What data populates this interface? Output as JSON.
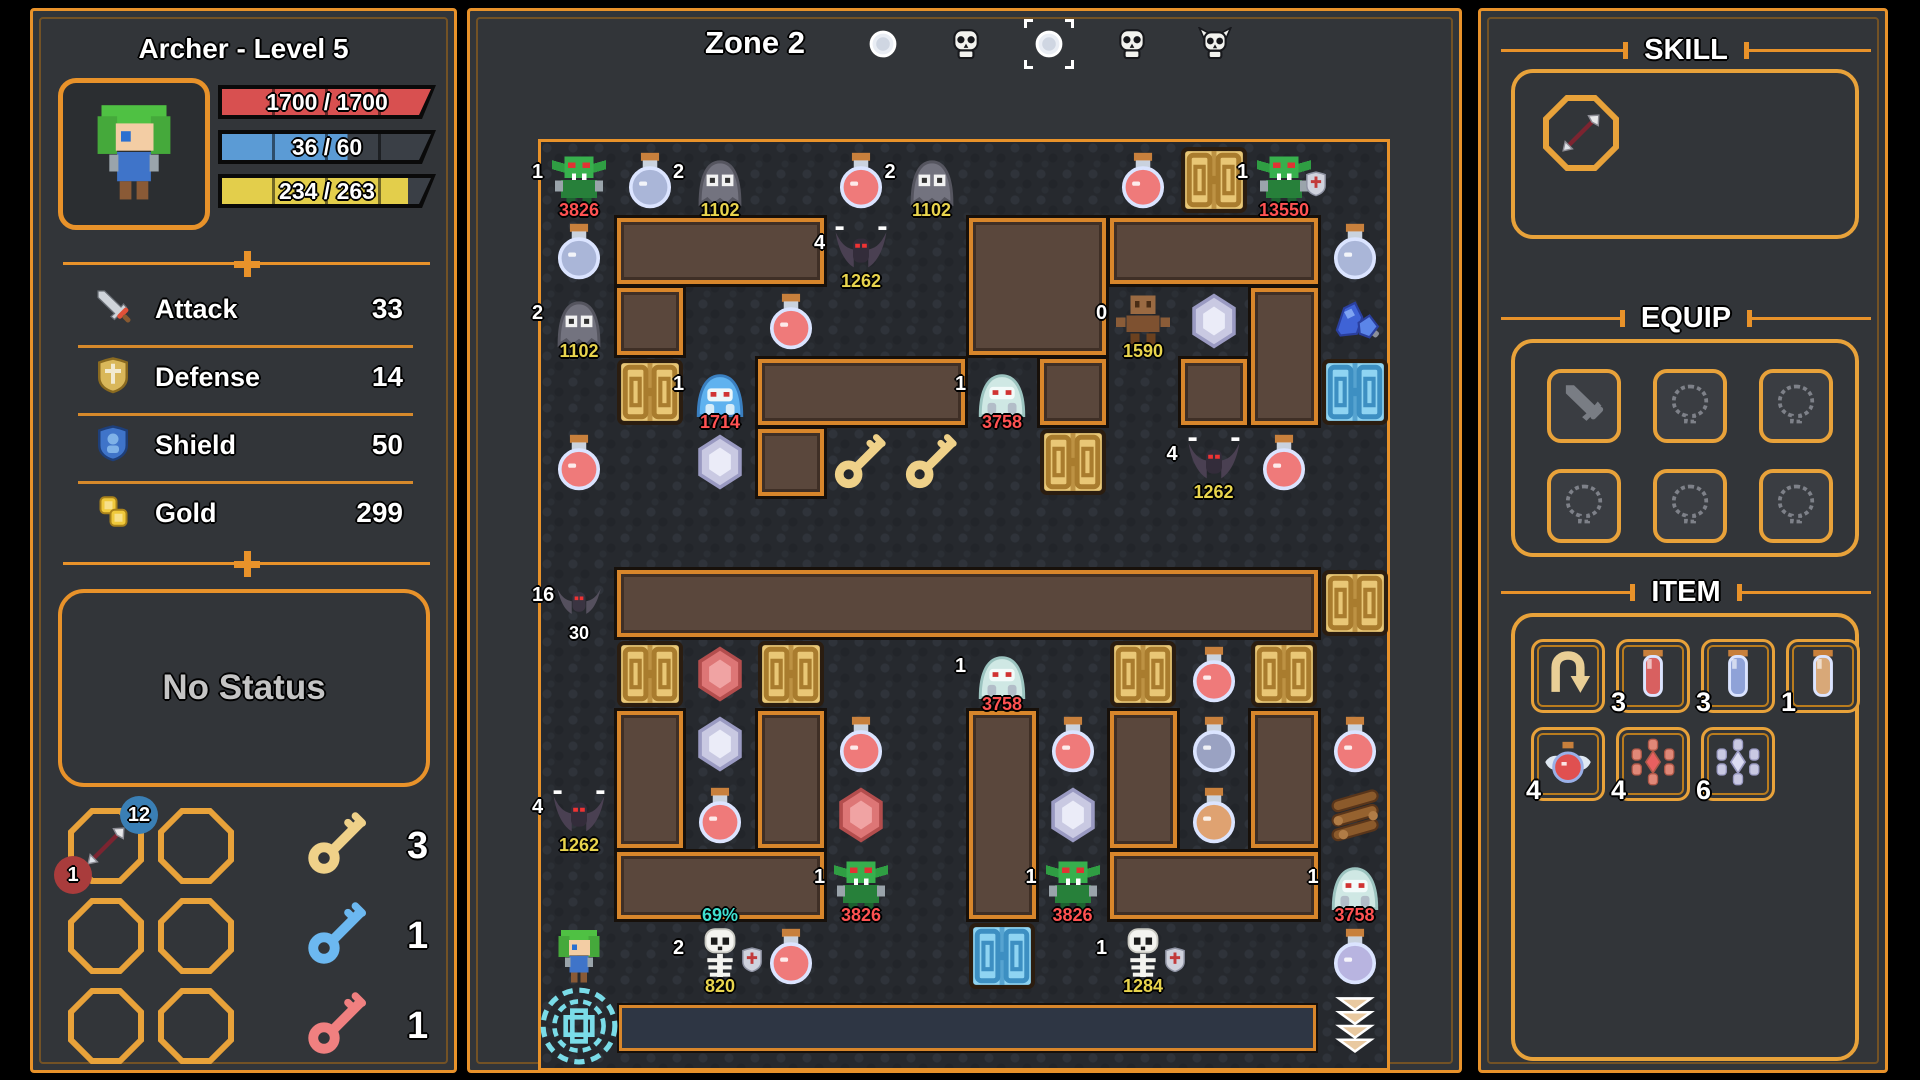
{
  "colors": {
    "accent": "#e8922a",
    "hp": "#d85050",
    "mp": "#5b9bd5",
    "exp": "#e3ce4b",
    "label_yellow": "#e8d44d",
    "label_red": "#ff5252",
    "label_cyan": "#3fe0d0"
  },
  "left_panel": {
    "title": "Archer  -  Level 5",
    "bars": [
      {
        "name": "hp",
        "text": "1700 / 1700",
        "fill": 1.0,
        "color": "#d85050"
      },
      {
        "name": "mp",
        "text": "36 / 60",
        "fill": 0.6,
        "color": "#5b9bd5"
      },
      {
        "name": "exp",
        "text": "234 / 263",
        "fill": 0.89,
        "color": "#e3ce4b"
      }
    ],
    "stats": [
      {
        "icon": "sword-icon",
        "label": "Attack",
        "value": "33"
      },
      {
        "icon": "shield-gold-icon",
        "label": "Defense",
        "value": "14"
      },
      {
        "icon": "shield-blue-icon",
        "label": "Shield",
        "value": "50"
      },
      {
        "icon": "coins-icon",
        "label": "Gold",
        "value": "299"
      }
    ],
    "status_text": "No Status",
    "skill_slots": [
      {
        "icon": "arrow-skill",
        "badge_top": "12",
        "badge_top_color": "#3a7fb5",
        "badge_bottom": "1",
        "badge_bottom_color": "#a93c3c"
      },
      {
        "icon": ""
      },
      {
        "icon": ""
      },
      {
        "icon": ""
      },
      {
        "icon": ""
      },
      {
        "icon": ""
      }
    ],
    "keys": [
      {
        "name": "yellow-key",
        "color": "#efd189",
        "count": "3"
      },
      {
        "name": "blue-key",
        "color": "#6cb8f0",
        "count": "1"
      },
      {
        "name": "red-key",
        "color": "#f08080",
        "count": "1"
      }
    ]
  },
  "map": {
    "zone_label": "Zone 2",
    "nav_icons": [
      {
        "icon": "orb-icon",
        "selected": false
      },
      {
        "icon": "skull-icon",
        "selected": false
      },
      {
        "icon": "orb-icon",
        "selected": true
      },
      {
        "icon": "skull-icon",
        "selected": false
      },
      {
        "icon": "demon-skull-icon",
        "selected": false
      }
    ],
    "grid": {
      "cols": 12,
      "rows": 13,
      "tile": 70.5
    },
    "walls": [
      {
        "row": 1,
        "col": 1,
        "w": 3,
        "h": 1
      },
      {
        "row": 1,
        "col": 6,
        "w": 2,
        "h": 2
      },
      {
        "row": 1,
        "col": 8,
        "w": 3,
        "h": 1
      },
      {
        "row": 2,
        "col": 1,
        "w": 1,
        "h": 1
      },
      {
        "row": 2,
        "col": 10,
        "w": 1,
        "h": 2
      },
      {
        "row": 3,
        "col": 3,
        "w": 3,
        "h": 1
      },
      {
        "row": 3,
        "col": 7,
        "w": 1,
        "h": 1
      },
      {
        "row": 3,
        "col": 9,
        "w": 1,
        "h": 1
      },
      {
        "row": 4,
        "col": 3,
        "w": 1,
        "h": 1
      },
      {
        "row": 6,
        "col": 1,
        "w": 10,
        "h": 1
      },
      {
        "row": 8,
        "col": 1,
        "w": 1,
        "h": 2
      },
      {
        "row": 8,
        "col": 3,
        "w": 1,
        "h": 2
      },
      {
        "row": 8,
        "col": 6,
        "w": 1,
        "h": 3
      },
      {
        "row": 8,
        "col": 8,
        "w": 1,
        "h": 2
      },
      {
        "row": 8,
        "col": 10,
        "w": 1,
        "h": 2
      },
      {
        "row": 10,
        "col": 1,
        "w": 3,
        "h": 1
      },
      {
        "row": 10,
        "col": 8,
        "w": 3,
        "h": 1
      }
    ],
    "bottom_bar": {
      "row": 12,
      "col": 1,
      "w": 10
    },
    "entities": [
      {
        "type": "goblin",
        "col": 0,
        "row": 0,
        "count": "1",
        "hp": "3826",
        "hp_color": "red"
      },
      {
        "type": "potion-blue",
        "col": 1,
        "row": 0
      },
      {
        "type": "ghost",
        "col": 2,
        "row": 0,
        "count": "2",
        "hp": "1102",
        "hp_color": "yellow"
      },
      {
        "type": "potion-red",
        "col": 4,
        "row": 0
      },
      {
        "type": "ghost",
        "col": 5,
        "row": 0,
        "count": "2",
        "hp": "1102",
        "hp_color": "yellow"
      },
      {
        "type": "potion-red",
        "col": 8,
        "row": 0
      },
      {
        "type": "door-yellow",
        "col": 9,
        "row": 0
      },
      {
        "type": "goblin",
        "col": 10,
        "row": 0,
        "count": "1",
        "hp": "13550",
        "hp_color": "red",
        "badge": true
      },
      {
        "type": "potion-blue",
        "col": 0,
        "row": 1
      },
      {
        "type": "bat",
        "col": 4,
        "row": 1,
        "count": "4",
        "hp": "1262",
        "hp_color": "yellow"
      },
      {
        "type": "potion-blue",
        "col": 11,
        "row": 1
      },
      {
        "type": "ghost",
        "col": 0,
        "row": 2,
        "count": "2",
        "hp": "1102",
        "hp_color": "yellow"
      },
      {
        "type": "potion-red",
        "col": 3,
        "row": 2
      },
      {
        "type": "golem",
        "col": 8,
        "row": 2,
        "count": "0",
        "hp": "1590",
        "hp_color": "yellow"
      },
      {
        "type": "gem-white",
        "col": 9,
        "row": 2
      },
      {
        "type": "crystal-blue",
        "col": 11,
        "row": 2
      },
      {
        "type": "door-yellow",
        "col": 1,
        "row": 3
      },
      {
        "type": "slime-blue",
        "col": 2,
        "row": 3,
        "count": "1",
        "hp": "1714",
        "hp_color": "red"
      },
      {
        "type": "slime-white",
        "col": 6,
        "row": 3,
        "count": "1",
        "hp": "3758",
        "hp_color": "red"
      },
      {
        "type": "door-blue",
        "col": 11,
        "row": 3
      },
      {
        "type": "potion-red",
        "col": 0,
        "row": 4
      },
      {
        "type": "gem-white",
        "col": 2,
        "row": 4
      },
      {
        "type": "key-yellow",
        "col": 4,
        "row": 4
      },
      {
        "type": "key-yellow",
        "col": 5,
        "row": 4
      },
      {
        "type": "door-yellow",
        "col": 7,
        "row": 4
      },
      {
        "type": "bat",
        "col": 9,
        "row": 4,
        "count": "4",
        "hp": "1262",
        "hp_color": "yellow"
      },
      {
        "type": "potion-red",
        "col": 10,
        "row": 4
      },
      {
        "type": "bat-small",
        "col": 0,
        "row": 6,
        "count": "16",
        "hp": "30",
        "hp_color": "white"
      },
      {
        "type": "door-yellow",
        "col": 11,
        "row": 6
      },
      {
        "type": "door-yellow",
        "col": 1,
        "row": 7
      },
      {
        "type": "gem-red",
        "col": 2,
        "row": 7
      },
      {
        "type": "door-yellow",
        "col": 3,
        "row": 7
      },
      {
        "type": "slime-white",
        "col": 6,
        "row": 7,
        "count": "1",
        "hp": "3758",
        "hp_color": "red"
      },
      {
        "type": "door-yellow",
        "col": 8,
        "row": 7
      },
      {
        "type": "potion-red",
        "col": 9,
        "row": 7
      },
      {
        "type": "door-yellow",
        "col": 10,
        "row": 7
      },
      {
        "type": "gem-white",
        "col": 2,
        "row": 8
      },
      {
        "type": "potion-red",
        "col": 4,
        "row": 8
      },
      {
        "type": "potion-red",
        "col": 7,
        "row": 8
      },
      {
        "type": "potion-slate",
        "col": 9,
        "row": 8
      },
      {
        "type": "potion-red",
        "col": 11,
        "row": 8
      },
      {
        "type": "bat",
        "col": 0,
        "row": 9,
        "count": "4",
        "hp": "1262",
        "hp_color": "yellow"
      },
      {
        "type": "potion-red",
        "col": 2,
        "row": 9
      },
      {
        "type": "gem-red",
        "col": 4,
        "row": 9
      },
      {
        "type": "gem-white",
        "col": 7,
        "row": 9
      },
      {
        "type": "potion-orange",
        "col": 9,
        "row": 9
      },
      {
        "type": "wood",
        "col": 11,
        "row": 9
      },
      {
        "type": "goblin",
        "col": 4,
        "row": 10,
        "count": "1",
        "hp": "3826",
        "hp_color": "red"
      },
      {
        "type": "goblin",
        "col": 7,
        "row": 10,
        "count": "1",
        "hp": "3826",
        "hp_color": "red"
      },
      {
        "type": "slime-white",
        "col": 11,
        "row": 10,
        "count": "1",
        "hp": "3758",
        "hp_color": "red"
      },
      {
        "type": "player",
        "col": 0,
        "row": 11
      },
      {
        "type": "skeleton",
        "col": 2,
        "row": 11,
        "count": "2",
        "hp": "820",
        "hp_color": "yellow",
        "top_label": "69%",
        "badge": true
      },
      {
        "type": "potion-red",
        "col": 3,
        "row": 11
      },
      {
        "type": "door-blue",
        "col": 6,
        "row": 11
      },
      {
        "type": "skeleton",
        "col": 8,
        "row": 11,
        "count": "1",
        "hp": "1284",
        "hp_color": "yellow",
        "badge": true
      },
      {
        "type": "potion-lavender",
        "col": 11,
        "row": 11
      },
      {
        "type": "portal",
        "col": 0,
        "row": 12
      },
      {
        "type": "arrows",
        "col": 11,
        "row": 12
      }
    ]
  },
  "right_panel": {
    "skill": {
      "title": "SKILL",
      "slots": [
        {
          "icon": "arrow-skill"
        }
      ]
    },
    "equip": {
      "title": "EQUIP",
      "slots": [
        "sword",
        "amulet",
        "amulet",
        "amulet",
        "amulet",
        "amulet"
      ]
    },
    "item": {
      "title": "ITEM",
      "items": [
        {
          "icon": "return-scroll",
          "count": ""
        },
        {
          "icon": "vial-red",
          "count": "3"
        },
        {
          "icon": "vial-blue",
          "count": "3"
        },
        {
          "icon": "vial-tan",
          "count": "1"
        },
        {
          "icon": "winged-potion",
          "count": "4"
        },
        {
          "icon": "gem-cluster-red",
          "count": "4"
        },
        {
          "icon": "gem-cluster-white",
          "count": "6"
        }
      ]
    }
  }
}
